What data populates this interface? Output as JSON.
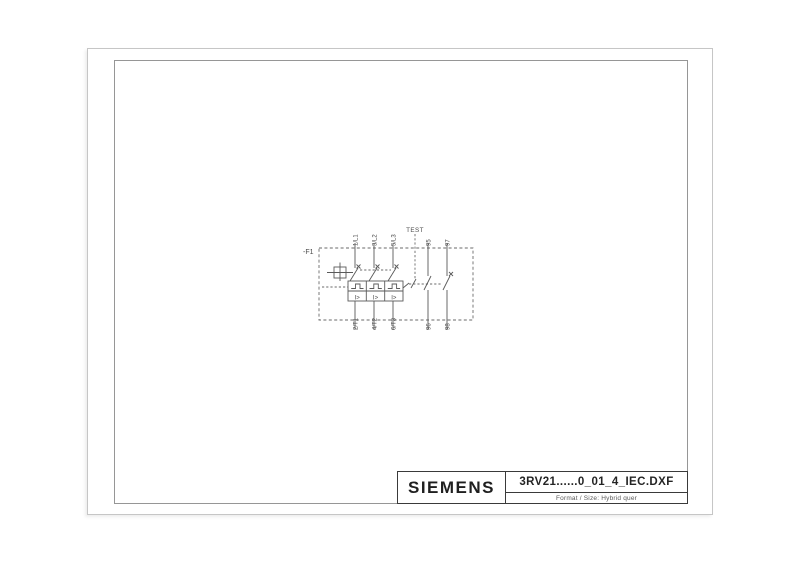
{
  "page": {
    "background": "#ffffff",
    "paper_edge_color": "#c6c6c6",
    "frame_color": "#969696",
    "line_color": "#5a5a5a",
    "label_color": "#4a4a4a"
  },
  "title_block": {
    "brand": "SIEMENS",
    "filename": "3RV21......0_01_4_IEC.DXF",
    "format_line": "Format / Size: Hybrid quer"
  },
  "schematic": {
    "device_label": "-F1",
    "test_label": "TEST",
    "top_terminals": [
      "1/L1",
      "3/L2",
      "5/L3"
    ],
    "bottom_terminals": [
      "2/T1",
      "4/T2",
      "6/T3"
    ],
    "aux_top_terminals": [
      "95",
      "97"
    ],
    "aux_bottom_terminals": [
      "96",
      "98"
    ],
    "trip_labels": [
      "I>",
      "I>",
      "I>"
    ]
  }
}
